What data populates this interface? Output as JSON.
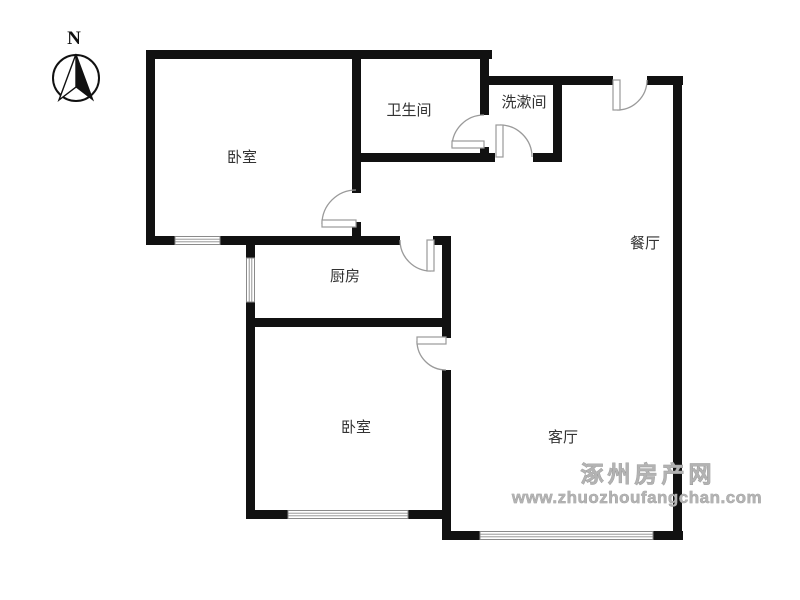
{
  "compass": {
    "label": "N"
  },
  "rooms": [
    {
      "name": "bedroom-top",
      "label": "卧室"
    },
    {
      "name": "bathroom",
      "label": "卫生间"
    },
    {
      "name": "washroom",
      "label": "洗漱间"
    },
    {
      "name": "dining-room",
      "label": "餐厅"
    },
    {
      "name": "kitchen",
      "label": "厨房"
    },
    {
      "name": "bedroom-bottom",
      "label": "卧室"
    },
    {
      "name": "living-room",
      "label": "客厅"
    }
  ],
  "watermark": {
    "site_name": "涿州房产网",
    "site_url": "www.zhuozhoufangchan.com"
  },
  "colors": {
    "wall": "#111111",
    "room_label": "#333333",
    "door": "#9a9a9a",
    "window_frame": "#8a8a8a",
    "watermark": "#b3b3b3",
    "background": "#ffffff"
  }
}
